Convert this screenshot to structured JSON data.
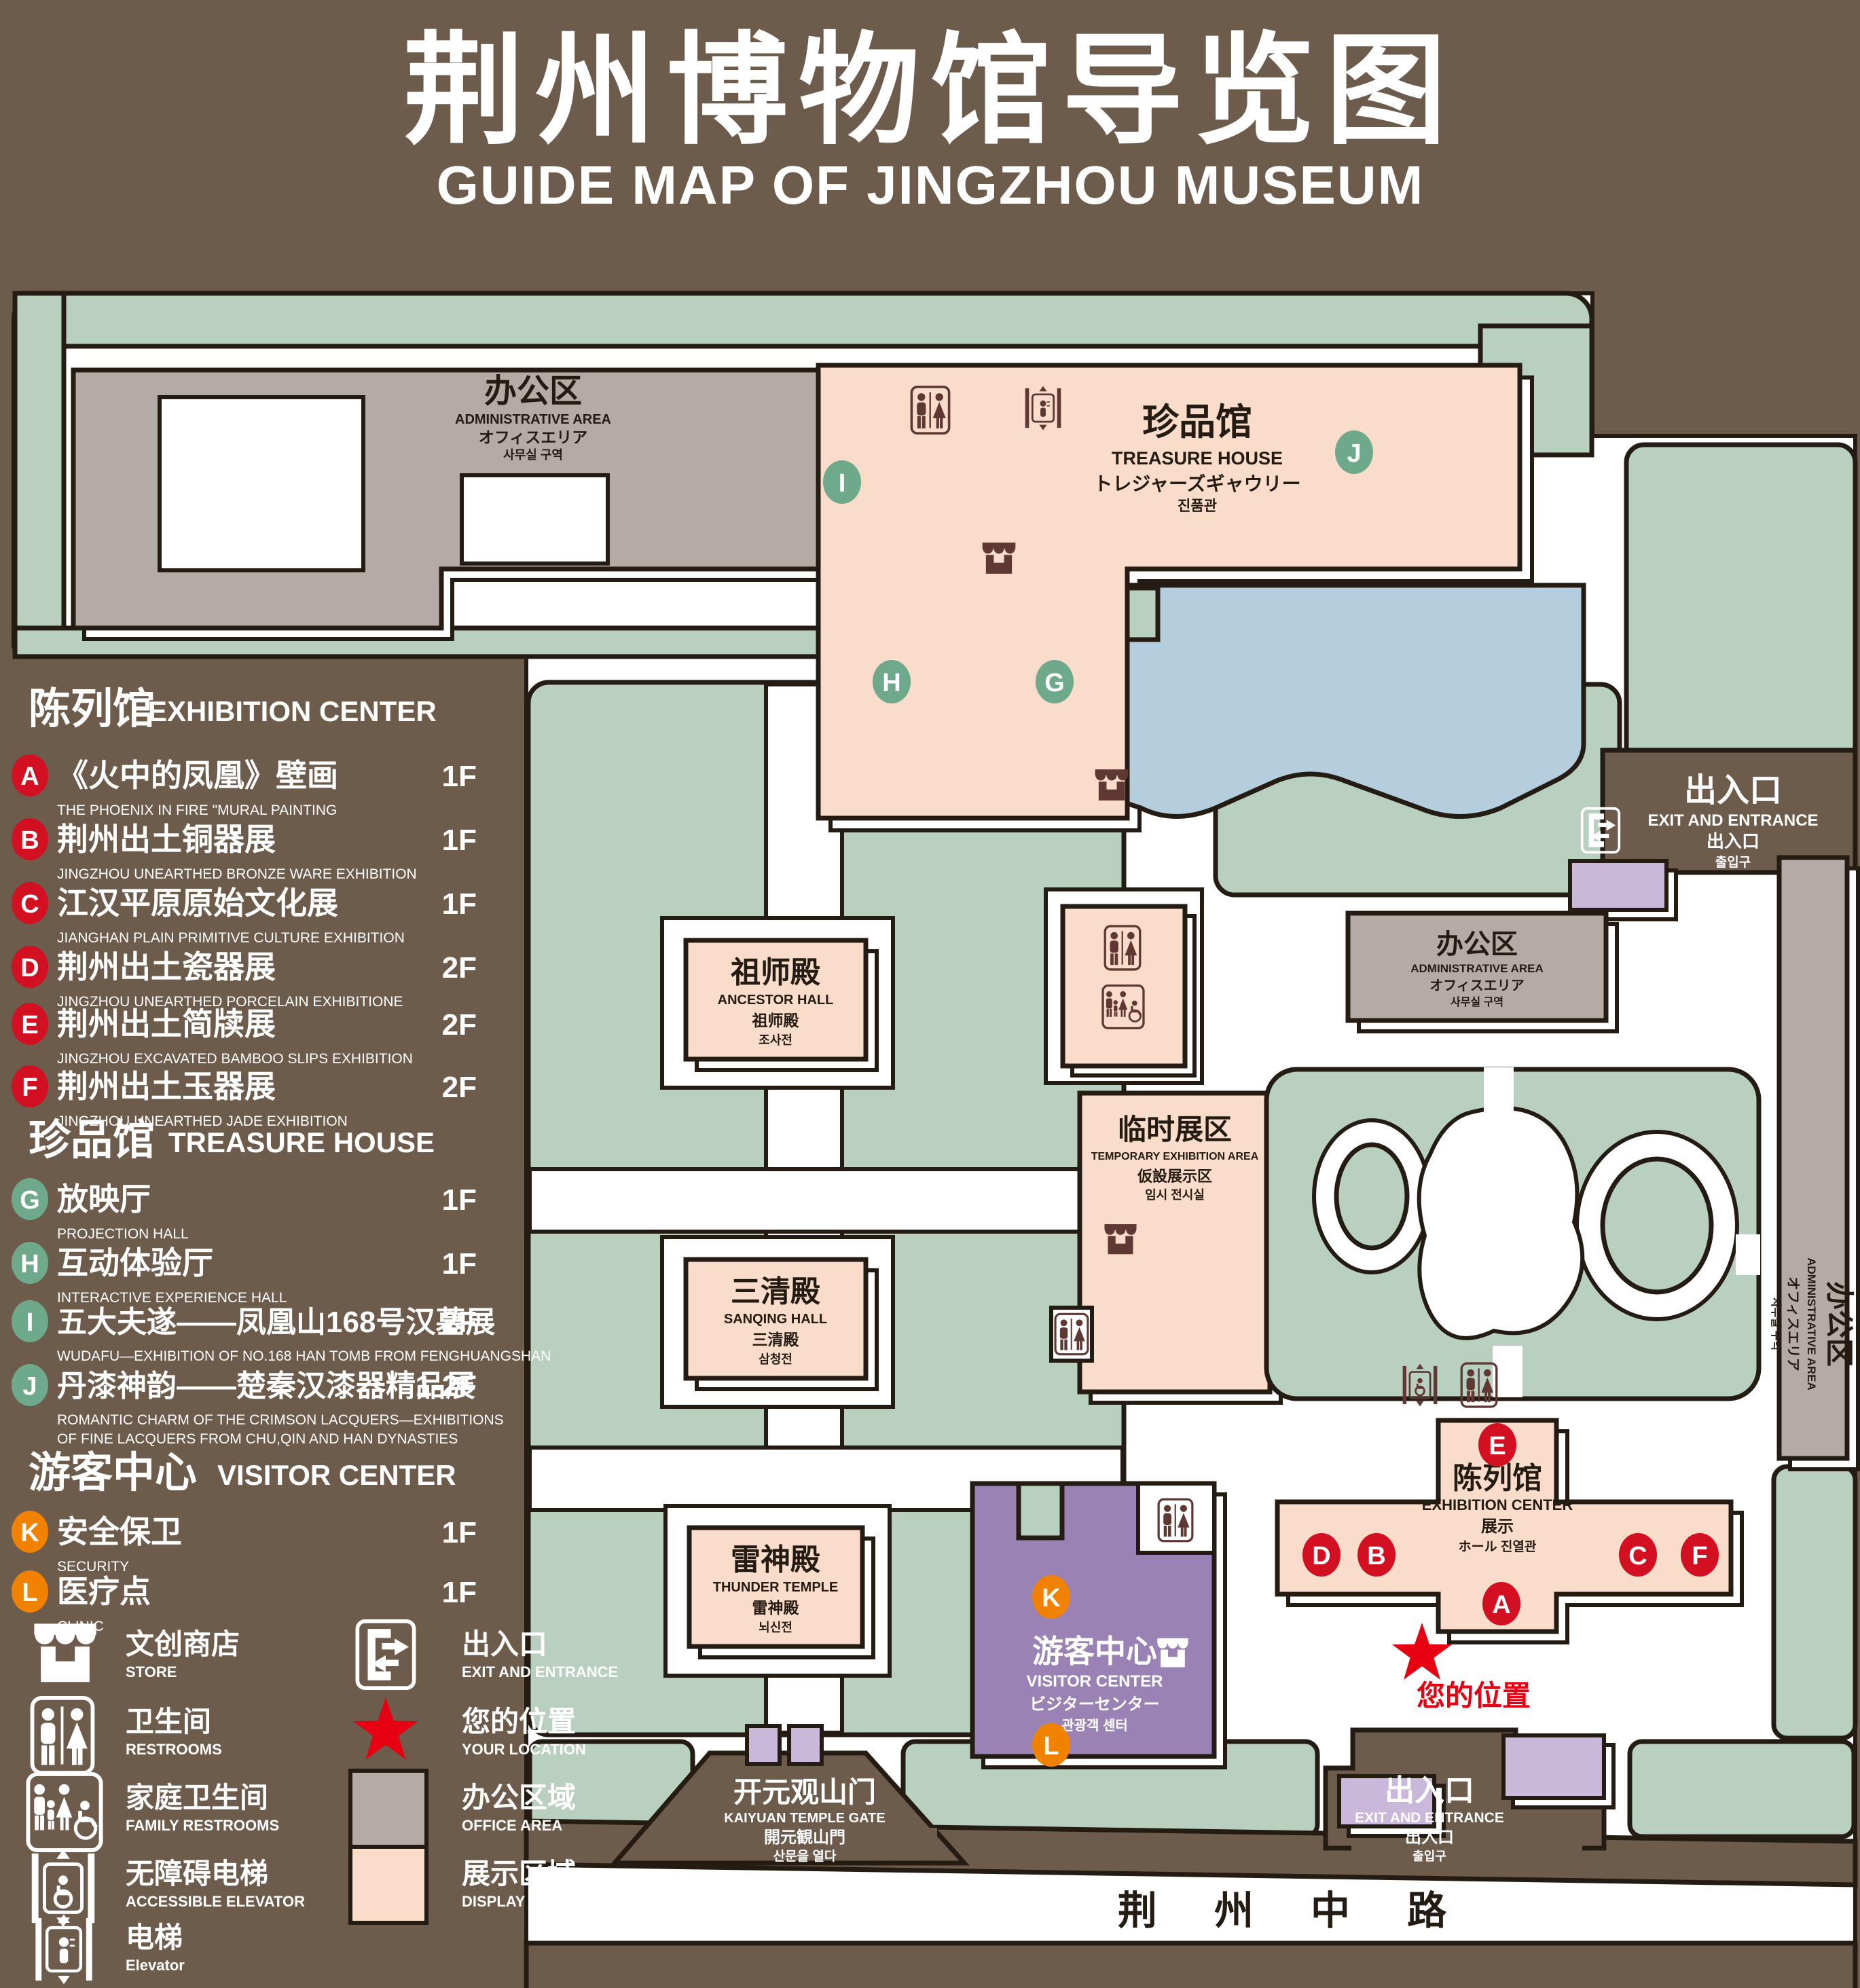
{
  "title": {
    "zh": "荆州博物馆导览图",
    "en": "GUIDE MAP OF JINGZHOU MUSEUM"
  },
  "legend": {
    "sections": [
      {
        "zh": "陈列馆",
        "en": "EXHIBITION CENTER",
        "items": [
          {
            "letter": "A",
            "zh": "《火中的凤凰》壁画",
            "en": "THE PHOENIX IN FIRE \"MURAL PAINTING",
            "floor": "1F"
          },
          {
            "letter": "B",
            "zh": "荆州出土铜器展",
            "en": "JINGZHOU UNEARTHED BRONZE WARE EXHIBITION",
            "floor": "1F"
          },
          {
            "letter": "C",
            "zh": "江汉平原原始文化展",
            "en": "JIANGHAN PLAIN PRIMITIVE CULTURE EXHIBITION",
            "floor": "1F"
          },
          {
            "letter": "D",
            "zh": "荆州出土瓷器展",
            "en": "JINGZHOU UNEARTHED PORCELAIN EXHIBITIONE",
            "floor": "2F"
          },
          {
            "letter": "E",
            "zh": "荆州出土简牍展",
            "en": "JINGZHOU EXCAVATED BAMBOO SLIPS EXHIBITION",
            "floor": "2F"
          },
          {
            "letter": "F",
            "zh": "荆州出土玉器展",
            "en": "JINGZHOU UNEARTHED JADE EXHIBITION",
            "floor": "2F"
          }
        ]
      },
      {
        "zh": "珍品馆",
        "en": "TREASURE HOUSE",
        "items": [
          {
            "letter": "G",
            "zh": "放映厅",
            "en": "PROJECTION HALL",
            "floor": "1F"
          },
          {
            "letter": "H",
            "zh": "互动体验厅",
            "en": "INTERACTIVE EXPERIENCE HALL",
            "floor": "1F"
          },
          {
            "letter": "I",
            "zh": "五大夫遂——凤凰山168号汉墓展",
            "en": "WUDAFU—EXHIBITION OF NO.168 HAN TOMB FROM FENGHUANGSHAN",
            "floor": "2F"
          },
          {
            "letter": "J",
            "zh": "丹漆神韵——楚秦汉漆器精品展",
            "en": "ROMANTIC CHARM OF THE CRIMSON LACQUERS—EXHIBITIONS",
            "en2": "OF FINE LACQUERS FROM CHU,QIN AND HAN DYNASTIES",
            "floor": "1-2F"
          }
        ]
      },
      {
        "zh": "游客中心",
        "en": "VISITOR CENTER",
        "items": [
          {
            "letter": "K",
            "zh": "安全保卫",
            "en": "SECURITY",
            "floor": "1F"
          },
          {
            "letter": "L",
            "zh": "医疗点",
            "en": "CLINIC",
            "floor": "1F"
          }
        ]
      }
    ],
    "symbols": [
      {
        "zh": "文创商店",
        "en": "STORE"
      },
      {
        "zh": "卫生间",
        "en": "RESTROOMS"
      },
      {
        "zh": "家庭卫生间",
        "en": "FAMILY RESTROOMS"
      },
      {
        "zh": "无障碍电梯",
        "en": "ACCESSIBLE ELEVATOR"
      },
      {
        "zh": "电梯",
        "en": "Elevator"
      },
      {
        "zh": "出入口",
        "en": "EXIT AND ENTRANCE"
      },
      {
        "zh": "您的位置",
        "en": "YOUR LOCATION"
      },
      {
        "zh": "办公区域",
        "en": "OFFICE AREA"
      },
      {
        "zh": "展示区域",
        "en": "DISPLAY AREA"
      }
    ]
  },
  "map": {
    "admin_nw": {
      "zh": "办公区",
      "en": "ADMINISTRATIVE AREA",
      "ja": "オフィスエリア",
      "ko": "사무실 구역"
    },
    "treasure": {
      "zh": "珍品馆",
      "en": "TREASURE HOUSE",
      "ja": "トレジャーズギャウリー",
      "ko": "진품관"
    },
    "exit_e": {
      "zh": "出入口",
      "en": "EXIT AND ENTRANCE",
      "ja": "出入口",
      "ko": "출입구"
    },
    "ancestor": {
      "zh": "祖师殿",
      "en": "ANCESTOR HALL",
      "ja": "祖师殿",
      "ko": "조사전"
    },
    "temporary": {
      "zh": "临时展区",
      "en": "TEMPORARY EXHIBITION AREA",
      "ja": "仮設展示区",
      "ko": "임시 전시실"
    },
    "admin_mid": {
      "zh": "办公区",
      "en": "ADMINISTRATIVE AREA",
      "ja": "オフィスエリア",
      "ko": "사무실 구역"
    },
    "sanqing": {
      "zh": "三清殿",
      "en": "SANQING HALL",
      "ja": "三清殿",
      "ko": "삼청전"
    },
    "thunder": {
      "zh": "雷神殿",
      "en": "THUNDER TEMPLE",
      "ja": "雷神殿",
      "ko": "뇌신전"
    },
    "visitor": {
      "zh": "游客中心",
      "en": "VISITOR CENTER",
      "ja": "ビジターセンター",
      "ko": "관광객 센터"
    },
    "exhibition": {
      "zh": "陈列馆",
      "en": "EXHIBITION CENTER",
      "ja": "展示",
      "ja2": "ホール 진열관"
    },
    "admin_e": {
      "zh": "办公区",
      "en": "ADMINISTRATIVE AREA",
      "ja": "オフィスエリア",
      "ko": "사무실 구역"
    },
    "gate": {
      "zh": "开元观山门",
      "en": "KAIYUAN TEMPLE GATE",
      "ja": "開元観山門",
      "ko": "산문을 열다"
    },
    "exit_s": {
      "zh": "出入口",
      "en": "EXIT AND ENTRANCE",
      "ja": "出入口",
      "ko": "출입구"
    },
    "road": "荆 州 中 路",
    "your_location": "您的位置",
    "markers": {
      "A": "A",
      "B": "B",
      "C": "C",
      "D": "D",
      "E": "E",
      "F": "F",
      "G": "G",
      "H": "H",
      "I": "I",
      "J": "J",
      "K": "K",
      "L": "L"
    }
  },
  "colors": {
    "background": "#6d5b4c",
    "lawn": "#b9cfc0",
    "office_area": "#b3aba5",
    "display_area": "#f9dcca",
    "water": "#b4cedd",
    "visitor_center": "#9a82b4",
    "entrance_block": "#c9b8d9",
    "marker_red": "#d30f22",
    "marker_green": "#6fa98c",
    "marker_orange": "#f08200",
    "icon_maroon": "#5f3833",
    "star_red": "#e60012"
  }
}
